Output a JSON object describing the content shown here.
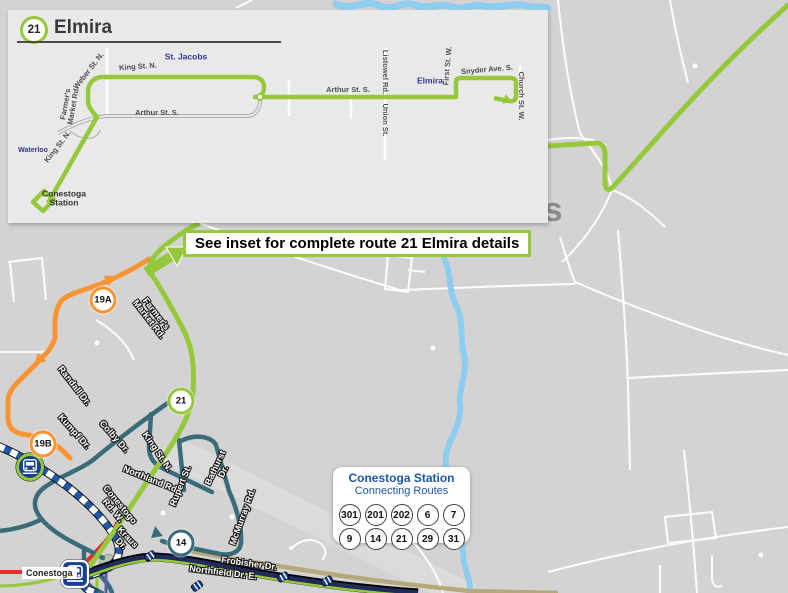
{
  "inset": {
    "badge": "21",
    "title": "Elmira",
    "places": {
      "st_jacobs": "St. Jacobs",
      "waterloo": "Waterloo",
      "elmira": "Elmira",
      "station": "Conestoga Station"
    },
    "streets": {
      "king_top": "King St. N.",
      "weber": "Weber St. N.",
      "farmers_market": "Farmer's Market Rd.",
      "arthur_south": "Arthur St. S.",
      "arthur_north": "Arthur St. S.",
      "listowel": "Listowel Rd.",
      "union": "Union St.",
      "first": "First St. W.",
      "snyder": "Snyder Ave. S.",
      "church": "Church St. W.",
      "king_diag": "King St. N."
    }
  },
  "map": {
    "big_label": "St. Jacobs",
    "callout": "See inset for complete route 21 Elmira details",
    "station_label": "Conestoga",
    "badges": {
      "b19a": "19A",
      "b19b": "19B",
      "b21": "21",
      "b14": "14"
    },
    "streets": {
      "farmers_market": "Farmer's Market Rd.",
      "randall": "Randall Dr.",
      "kumpf": "Kumpf Dr.",
      "colby": "Colby Dr.",
      "king": "King St. N.",
      "northland": "Northland Rd.",
      "rupert": "Rupert St.",
      "bathurst": "Bathurst Dr.",
      "mcmurray": "McMurray Rd.",
      "conestogo": "Conestogo Rd. W.",
      "kraus": "Kraus Dr.",
      "frobisher": "Frobisher Dr.",
      "northfield": "Northfield Dr. E."
    }
  },
  "connecting": {
    "title": "Conestoga Station",
    "subtitle": "Connecting Routes",
    "row1": [
      "301",
      "201",
      "202",
      "6",
      "7"
    ],
    "row2": [
      "9",
      "14",
      "21",
      "29",
      "31"
    ]
  },
  "colors": {
    "route_green": "#96C83C",
    "route_orange": "#F79433",
    "route_teal": "#3A6B78",
    "ion_blue": "#2257A8",
    "navy": "#202B5C",
    "red": "#E62E2A",
    "khaki": "#B3A97C",
    "water": "#8FCDEF",
    "place_blue": "#2B3990",
    "map_bg": "#D3D3D3",
    "inset_bg": "#EAE9E9"
  }
}
